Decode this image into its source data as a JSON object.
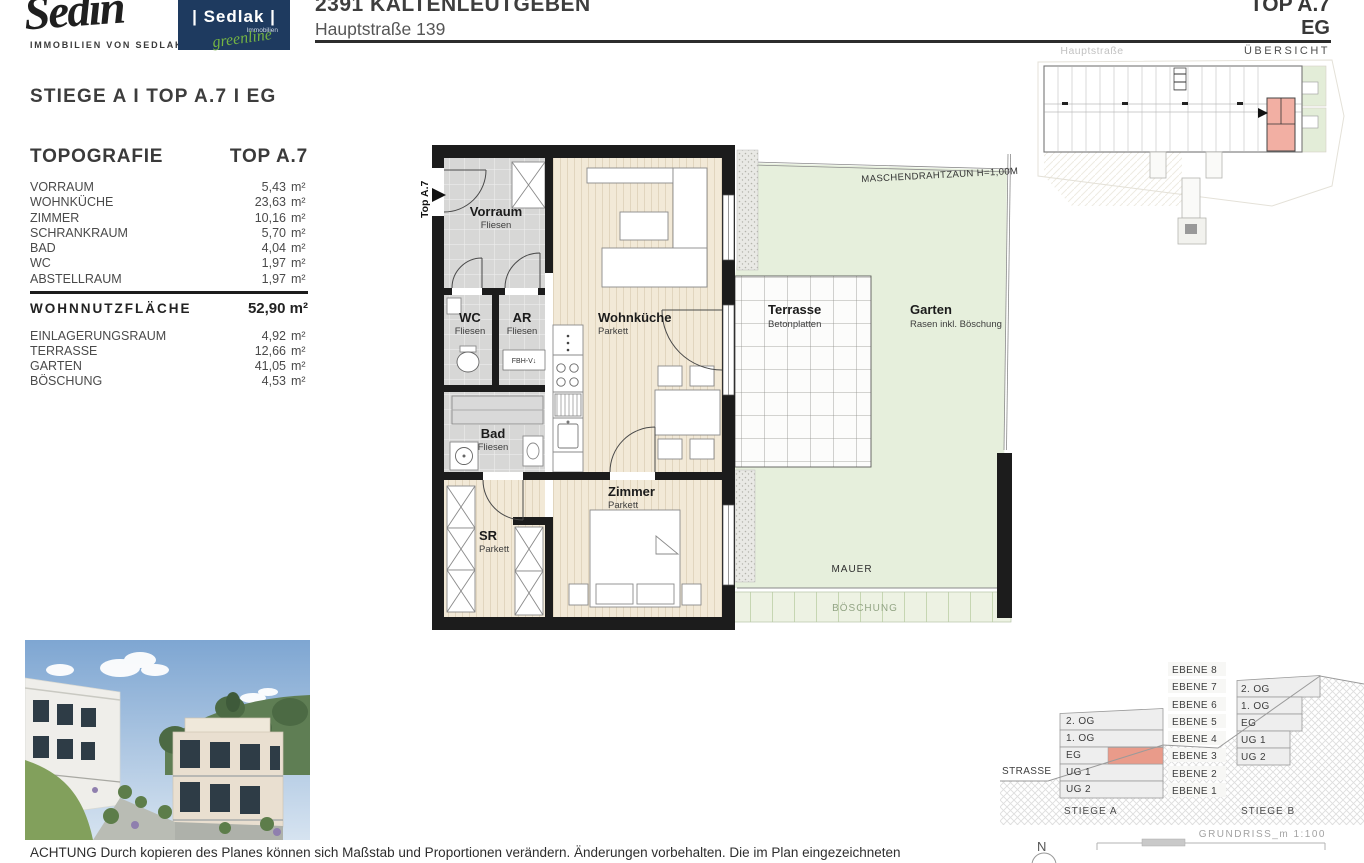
{
  "header": {
    "brand_script": "Sedin",
    "brand_tagline": "IMMOBILIEN VON SEDLAK",
    "logo_name": "| Sedlak |",
    "logo_sub": "Immobilien",
    "logo_script": "greenline",
    "title": "2391 KALTENLEUTGEBEN",
    "subtitle": "Hauptstraße 139",
    "unit": "TOP A.7",
    "floor": "EG",
    "street": "Hauptstraße",
    "overview": "ÜBERSICHT"
  },
  "panel": {
    "heading": "STIEGE A  I  TOP A.7  I  EG",
    "table_title": "TOPOGRAFIE",
    "table_col": "TOP A.7",
    "rooms": [
      {
        "name": "VORRAUM",
        "value": "5,43",
        "unit": "m²"
      },
      {
        "name": "WOHNKÜCHE",
        "value": "23,63",
        "unit": "m²"
      },
      {
        "name": "ZIMMER",
        "value": "10,16",
        "unit": "m²"
      },
      {
        "name": "SCHRANKRAUM",
        "value": "5,70",
        "unit": "m²"
      },
      {
        "name": "BAD",
        "value": "4,04",
        "unit": "m²"
      },
      {
        "name": "WC",
        "value": "1,97",
        "unit": "m²"
      },
      {
        "name": "ABSTELLRAUM",
        "value": "1,97",
        "unit": "m²"
      }
    ],
    "total_label": "WOHNNUTZFLÄCHE",
    "total_value": "52,90 m²",
    "extras": [
      {
        "name": "EINLAGERUNGSRAUM",
        "value": "4,92",
        "unit": "m²"
      },
      {
        "name": "TERRASSE",
        "value": "12,66",
        "unit": "m²"
      },
      {
        "name": "GARTEN",
        "value": "41,05",
        "unit": "m²"
      },
      {
        "name": "BÖSCHUNG",
        "value": "4,53",
        "unit": "m²"
      }
    ]
  },
  "plan": {
    "entry": "Top A.7",
    "vorraum": {
      "name": "Vorraum",
      "sub": "Fliesen"
    },
    "wc": {
      "name": "WC",
      "sub": "Fliesen"
    },
    "ar": {
      "name": "AR",
      "sub": "Fliesen"
    },
    "fbh": "FBH-V↓",
    "bad": {
      "name": "Bad",
      "sub": "Fliesen"
    },
    "sr": {
      "name": "SR",
      "sub": "Parkett"
    },
    "wohnkueche": {
      "name": "Wohnküche",
      "sub": "Parkett"
    },
    "zimmer": {
      "name": "Zimmer",
      "sub": "Parkett"
    },
    "terrasse": {
      "name": "Terrasse",
      "sub": "Betonplatten"
    },
    "garten": {
      "name": "Garten",
      "sub": "Rasen inkl. Böschung"
    },
    "fence": "MASCHENDRAHTZAUN H=1,00M",
    "mauer": "MAUER",
    "boeschung": "BÖSCHUNG"
  },
  "levels": {
    "ebenen": [
      "EBENE 8",
      "EBENE 7",
      "EBENE 6",
      "EBENE 5",
      "EBENE 4",
      "EBENE 3",
      "EBENE 2",
      "EBENE 1"
    ],
    "stiege_a_floors": [
      "2. OG",
      "1. OG",
      "EG",
      "UG 1",
      "UG 2"
    ],
    "stiege_b_floors": [
      "2. OG",
      "1. OG",
      "EG",
      "UG 1",
      "UG 2"
    ],
    "stiege_a": "STIEGE A",
    "stiege_b": "STIEGE B",
    "strasse": "STRASSE",
    "scale": "GRUNDRISS_m 1:100",
    "north": "N"
  },
  "footer": {
    "disclaimer": "ACHTUNG Durch kopieren des Planes können sich Maßstab und Proportionen verändern. Änderungen vorbehalten. Die im Plan eingezeichneten"
  },
  "colors": {
    "accent_red": "#E99B8A",
    "garden_green": "#E6EFDC",
    "navy": "#1E3A5F",
    "greenline": "#74B343",
    "parquet": "#F2E9D7",
    "tile": "#D7D7D6"
  }
}
